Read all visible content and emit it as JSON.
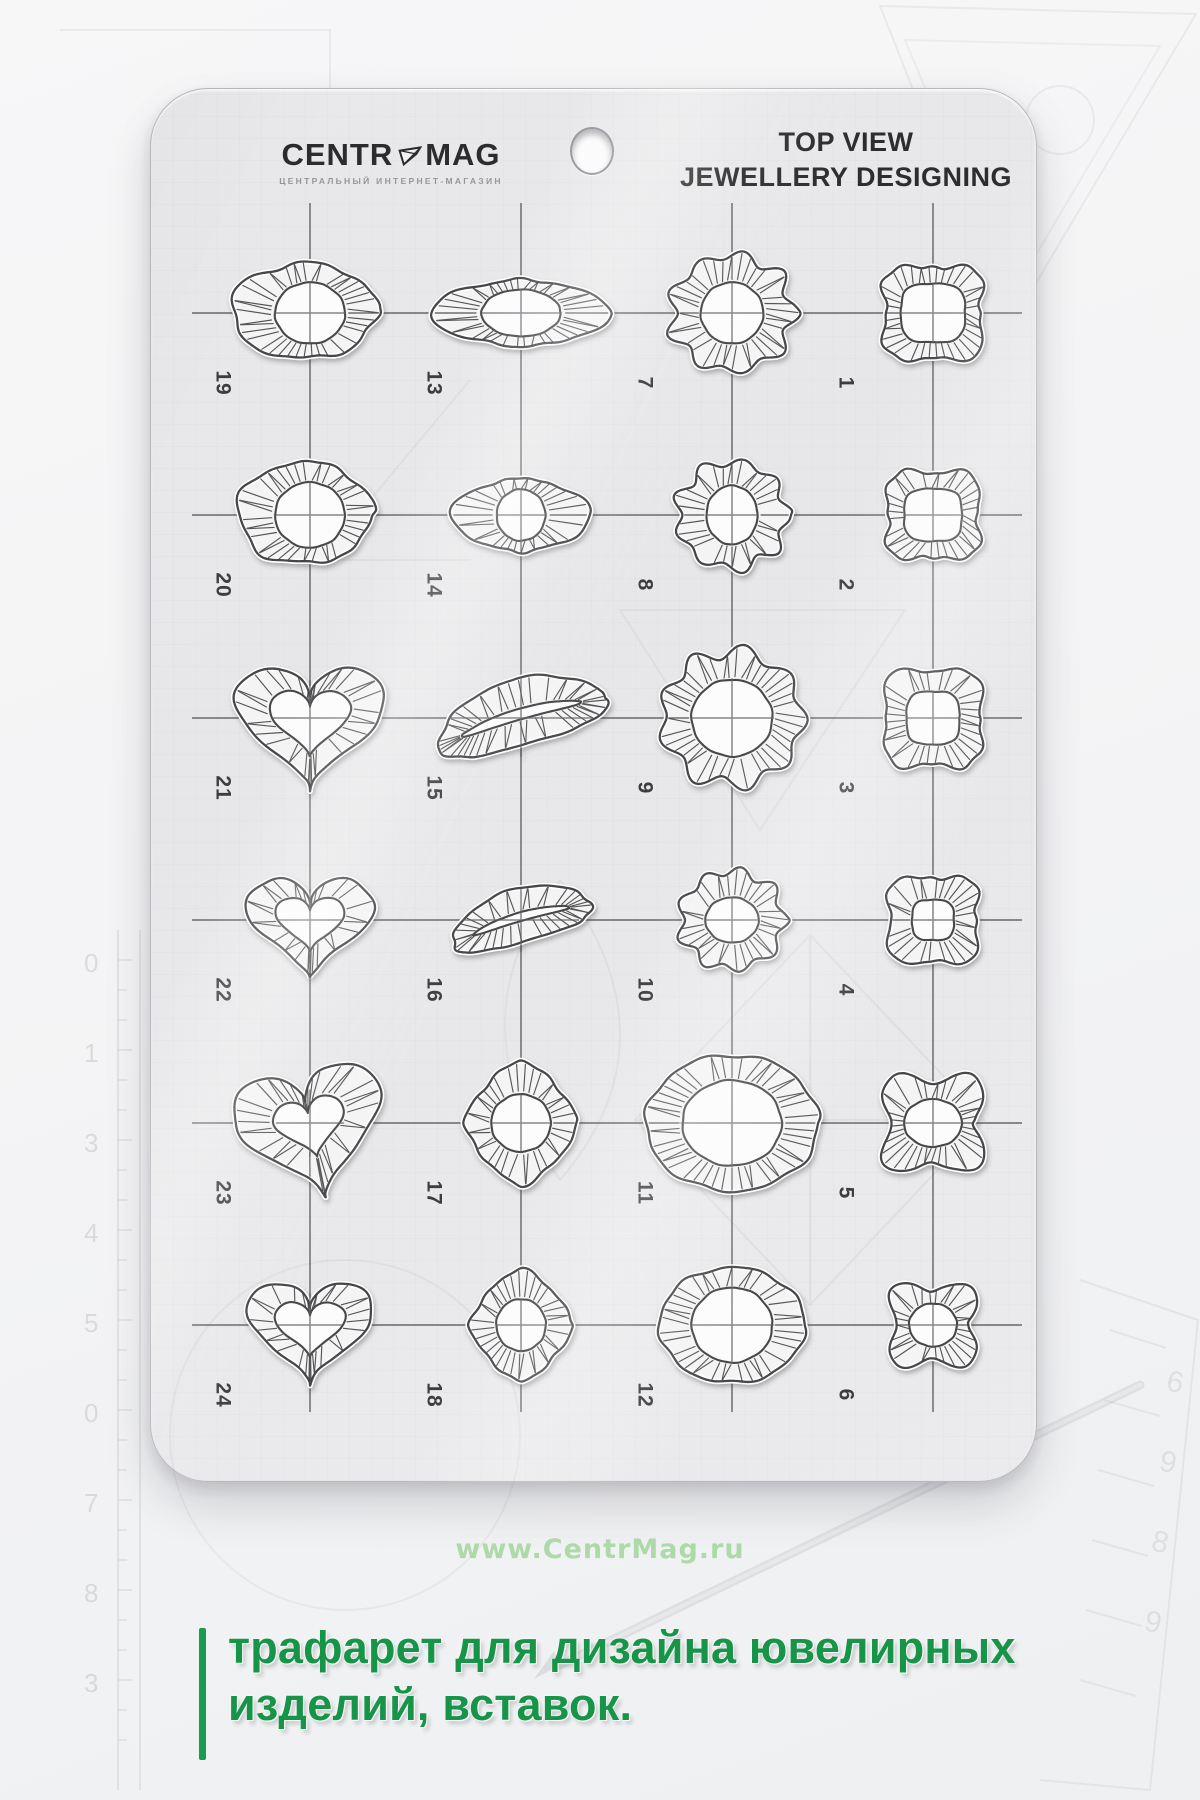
{
  "colors": {
    "accent_green": "#169447",
    "caption_bar_green": "#1a9b4d",
    "watermark_green": "#a6d7a0",
    "plate_gray": "#e9e9eb",
    "ink": "#2d2d2e",
    "grid_line": "#5f5f63",
    "gem_stroke": "#474749",
    "hatch": "#3a3a3c",
    "number_ink": "#3d3d40"
  },
  "header": {
    "logo_part1": "CENTR",
    "logo_part2": "MAG",
    "logo_icon": "diamond-icon",
    "logo_tagline": "ЦЕНТРАЛЬНЫЙ ИНТЕРНЕТ-МАГАЗИН",
    "title_line1": "TOP VIEW",
    "title_line2": "JEWELLERY DESIGNING"
  },
  "stencil": {
    "columns_x": [
      310,
      521,
      732,
      933
    ],
    "rows_y": [
      313,
      515,
      718,
      920,
      1123,
      1325
    ],
    "grid": {
      "v_top": 203,
      "v_bottom": 1412,
      "h_left": 192,
      "h_right": 1022
    },
    "number_offset": {
      "dx": -88,
      "dy": 70
    },
    "cells": [
      {
        "label": "19",
        "shape": "pear",
        "col": 0,
        "row": 0,
        "w": 152,
        "h": 118,
        "hw": 0.46,
        "hh": 0.52,
        "rot": 0
      },
      {
        "label": "20",
        "shape": "pear",
        "col": 0,
        "row": 1,
        "w": 140,
        "h": 126,
        "hw": 0.5,
        "hh": 0.52,
        "rot": 0
      },
      {
        "label": "21",
        "shape": "heart",
        "col": 0,
        "row": 2,
        "w": 150,
        "h": 146,
        "hw": 0.5,
        "hh": 0.5,
        "rot": 0
      },
      {
        "label": "22",
        "shape": "heart",
        "col": 0,
        "row": 3,
        "w": 128,
        "h": 120,
        "hw": 0.5,
        "hh": 0.5,
        "rot": 0
      },
      {
        "label": "23",
        "shape": "heart",
        "col": 0,
        "row": 4,
        "w": 150,
        "h": 154,
        "hw": 0.44,
        "hh": 0.42,
        "rot": -12
      },
      {
        "label": "24",
        "shape": "heart",
        "col": 0,
        "row": 5,
        "w": 126,
        "h": 122,
        "hw": 0.52,
        "hh": 0.5,
        "rot": 0
      },
      {
        "label": "13",
        "shape": "marquise",
        "col": 1,
        "row": 0,
        "w": 158,
        "h": 102,
        "hw": 0.5,
        "hh": 0.46,
        "rot": 0
      },
      {
        "label": "14",
        "shape": "marquise",
        "col": 1,
        "row": 1,
        "w": 122,
        "h": 112,
        "hw": 0.4,
        "hh": 0.46,
        "rot": 0
      },
      {
        "label": "15",
        "shape": "lips",
        "col": 1,
        "row": 2,
        "w": 174,
        "h": 126,
        "hw": 0.8,
        "hh": 0.6,
        "rot": -16
      },
      {
        "label": "16",
        "shape": "lips",
        "col": 1,
        "row": 3,
        "w": 144,
        "h": 102,
        "hw": 0.78,
        "hh": 0.6,
        "rot": -16
      },
      {
        "label": "17",
        "shape": "kite",
        "col": 1,
        "row": 4,
        "w": 130,
        "h": 144,
        "hw": 0.46,
        "hh": 0.4,
        "rot": 0
      },
      {
        "label": "18",
        "shape": "kite",
        "col": 1,
        "row": 5,
        "w": 118,
        "h": 130,
        "hw": 0.42,
        "hh": 0.4,
        "rot": 0
      },
      {
        "label": "7",
        "shape": "flower",
        "col": 2,
        "row": 0,
        "w": 136,
        "h": 128,
        "hw": 0.46,
        "hh": 0.48,
        "rot": 0
      },
      {
        "label": "8",
        "shape": "flower",
        "col": 2,
        "row": 1,
        "w": 122,
        "h": 118,
        "hw": 0.42,
        "hh": 0.5,
        "rot": 0
      },
      {
        "label": "9",
        "shape": "flower",
        "col": 2,
        "row": 2,
        "w": 156,
        "h": 148,
        "hw": 0.52,
        "hh": 0.52,
        "rot": 0
      },
      {
        "label": "10",
        "shape": "flower",
        "col": 2,
        "row": 3,
        "w": 116,
        "h": 108,
        "hw": 0.46,
        "hh": 0.42,
        "rot": 0
      },
      {
        "label": "11",
        "shape": "oval",
        "col": 2,
        "row": 4,
        "w": 178,
        "h": 158,
        "hw": 0.56,
        "hh": 0.54,
        "rot": 0
      },
      {
        "label": "12",
        "shape": "oval",
        "col": 2,
        "row": 5,
        "w": 150,
        "h": 134,
        "hw": 0.54,
        "hh": 0.56,
        "rot": 0
      },
      {
        "label": "1",
        "shape": "cushion",
        "col": 3,
        "row": 0,
        "w": 128,
        "h": 122,
        "hw": 0.5,
        "hh": 0.48,
        "rot": 0
      },
      {
        "label": "2",
        "shape": "cushion",
        "col": 3,
        "row": 1,
        "w": 120,
        "h": 114,
        "hw": 0.48,
        "hh": 0.46,
        "rot": 0
      },
      {
        "label": "3",
        "shape": "cushion",
        "col": 3,
        "row": 2,
        "w": 126,
        "h": 126,
        "hw": 0.42,
        "hh": 0.42,
        "rot": 0
      },
      {
        "label": "4",
        "shape": "cushion",
        "col": 3,
        "row": 3,
        "w": 116,
        "h": 112,
        "hw": 0.36,
        "hh": 0.36,
        "rot": 0
      },
      {
        "label": "5",
        "shape": "clover",
        "col": 3,
        "row": 4,
        "w": 132,
        "h": 126,
        "hw": 0.44,
        "hh": 0.38,
        "rot": 0
      },
      {
        "label": "6",
        "shape": "clover",
        "col": 3,
        "row": 5,
        "w": 114,
        "h": 108,
        "hw": 0.42,
        "hh": 0.4,
        "rot": 0
      }
    ]
  },
  "watermark": {
    "text": "www.CentrMag.ru"
  },
  "caption": {
    "line1": "трафарет для дизайна ювелирных",
    "line2": "изделий, вставок."
  }
}
